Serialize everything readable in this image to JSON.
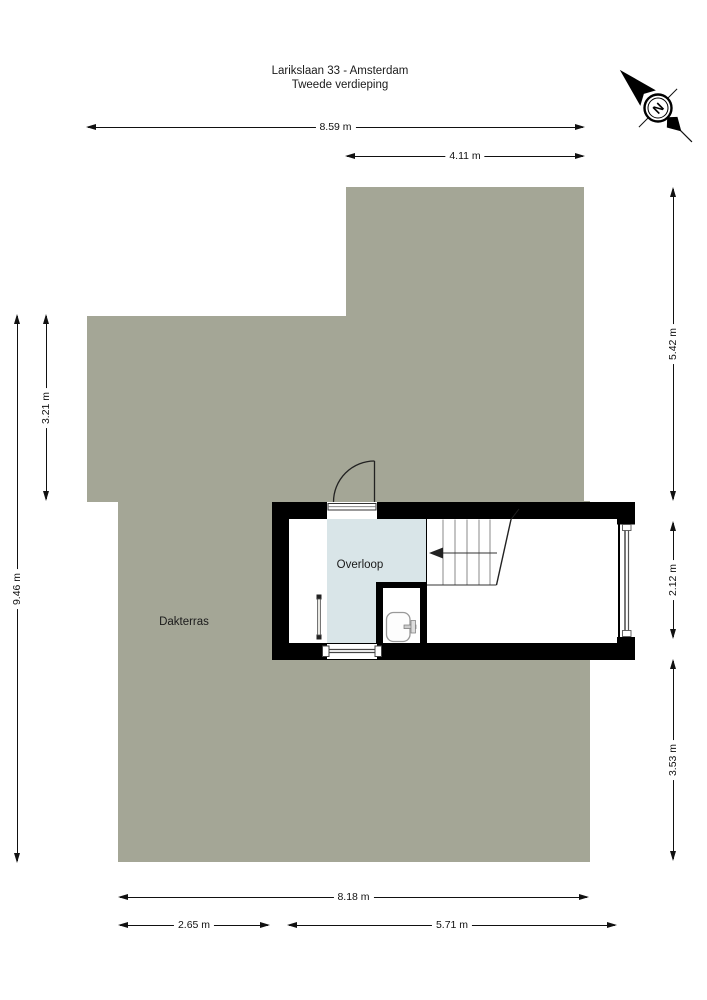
{
  "title": {
    "line1": "Larikslaan 33 - Amsterdam",
    "line2": "Tweede verdieping"
  },
  "compass": {
    "north_label": "N"
  },
  "rooms": {
    "terrace_label": "Dakterras",
    "landing_label": "Overloop"
  },
  "dimensions": {
    "top": [
      {
        "label": "8.59 m"
      },
      {
        "label": "4.11 m"
      }
    ],
    "left": [
      {
        "label": "3.21 m"
      },
      {
        "label": "9.46 m"
      }
    ],
    "right": [
      {
        "label": "5.42 m"
      },
      {
        "label": "2.12 m"
      },
      {
        "label": "3.53 m"
      }
    ],
    "bottom": [
      {
        "label": "8.18 m"
      },
      {
        "label": "2.65 m"
      },
      {
        "label": "5.71 m"
      }
    ]
  },
  "colors": {
    "terrace": "#a4a696",
    "landing": "#d9e5e8",
    "wall": "#000000"
  }
}
